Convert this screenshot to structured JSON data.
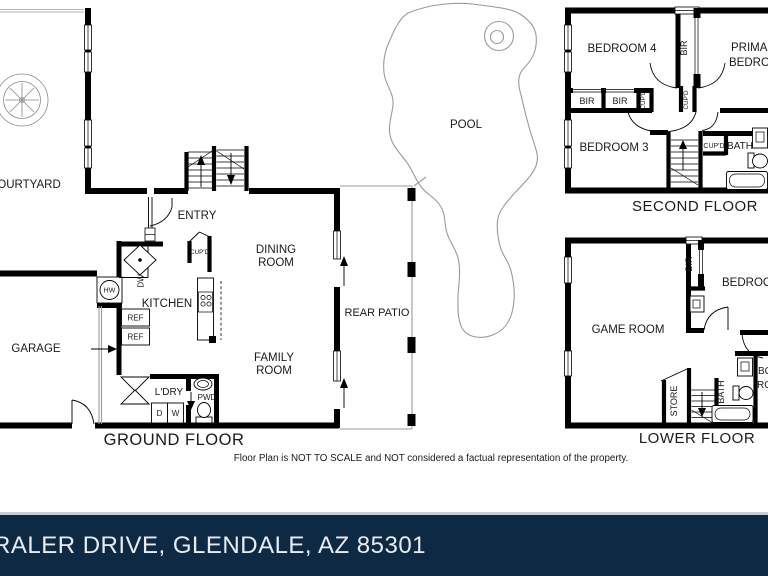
{
  "page": {
    "disclaimer": "Floor Plan is NOT TO SCALE and NOT considered a factual representation of the property.",
    "address": "RALER DRIVE, GLENDALE, AZ 85301",
    "banner_bg": "#0d2943",
    "banner_text_color": "#e8ecf2",
    "wall_color": "#000000"
  },
  "pool": {
    "label": "POOL"
  },
  "ground_floor": {
    "title": "GROUND FLOOR",
    "labels": {
      "courtyard": "COURTYARD",
      "entry": "ENTRY",
      "kitchen": "KITCHEN",
      "dining_1": "DINING",
      "dining_2": "ROOM",
      "family_1": "FAMILY",
      "family_2": "ROOM",
      "rear_patio": "REAR PATIO",
      "garage": "GARAGE",
      "laundry": "L'DRY",
      "powder": "PWD",
      "cupboard": "CUP'D",
      "dishwasher": "DW",
      "hot_water": "HW",
      "fridge_1": "REF",
      "fridge_2": "REF",
      "dryer": "D",
      "washer": "W"
    }
  },
  "second_floor": {
    "title": "SECOND FLOOR",
    "labels": {
      "bedroom4": "BEDROOM 4",
      "bedroom3": "BEDROOM 3",
      "primary_1": "PRIMARY",
      "primary_2": "BEDROOM",
      "bir_corridor": "BIR",
      "bir_1": "BIR",
      "bir_2": "BIR",
      "cupd_1": "CUP'D",
      "cupd_2": "CUP'D",
      "cupd_3": "CUP'D",
      "bath": "BATH"
    }
  },
  "lower_floor": {
    "title": "LOWER FLOOR",
    "labels": {
      "game_room": "GAME ROOM",
      "bedroom": "BEDROOM",
      "bir": "BIR",
      "store": "STORE",
      "bath": "BATH",
      "box_1": "BOX",
      "box_2": "ROOM"
    }
  }
}
